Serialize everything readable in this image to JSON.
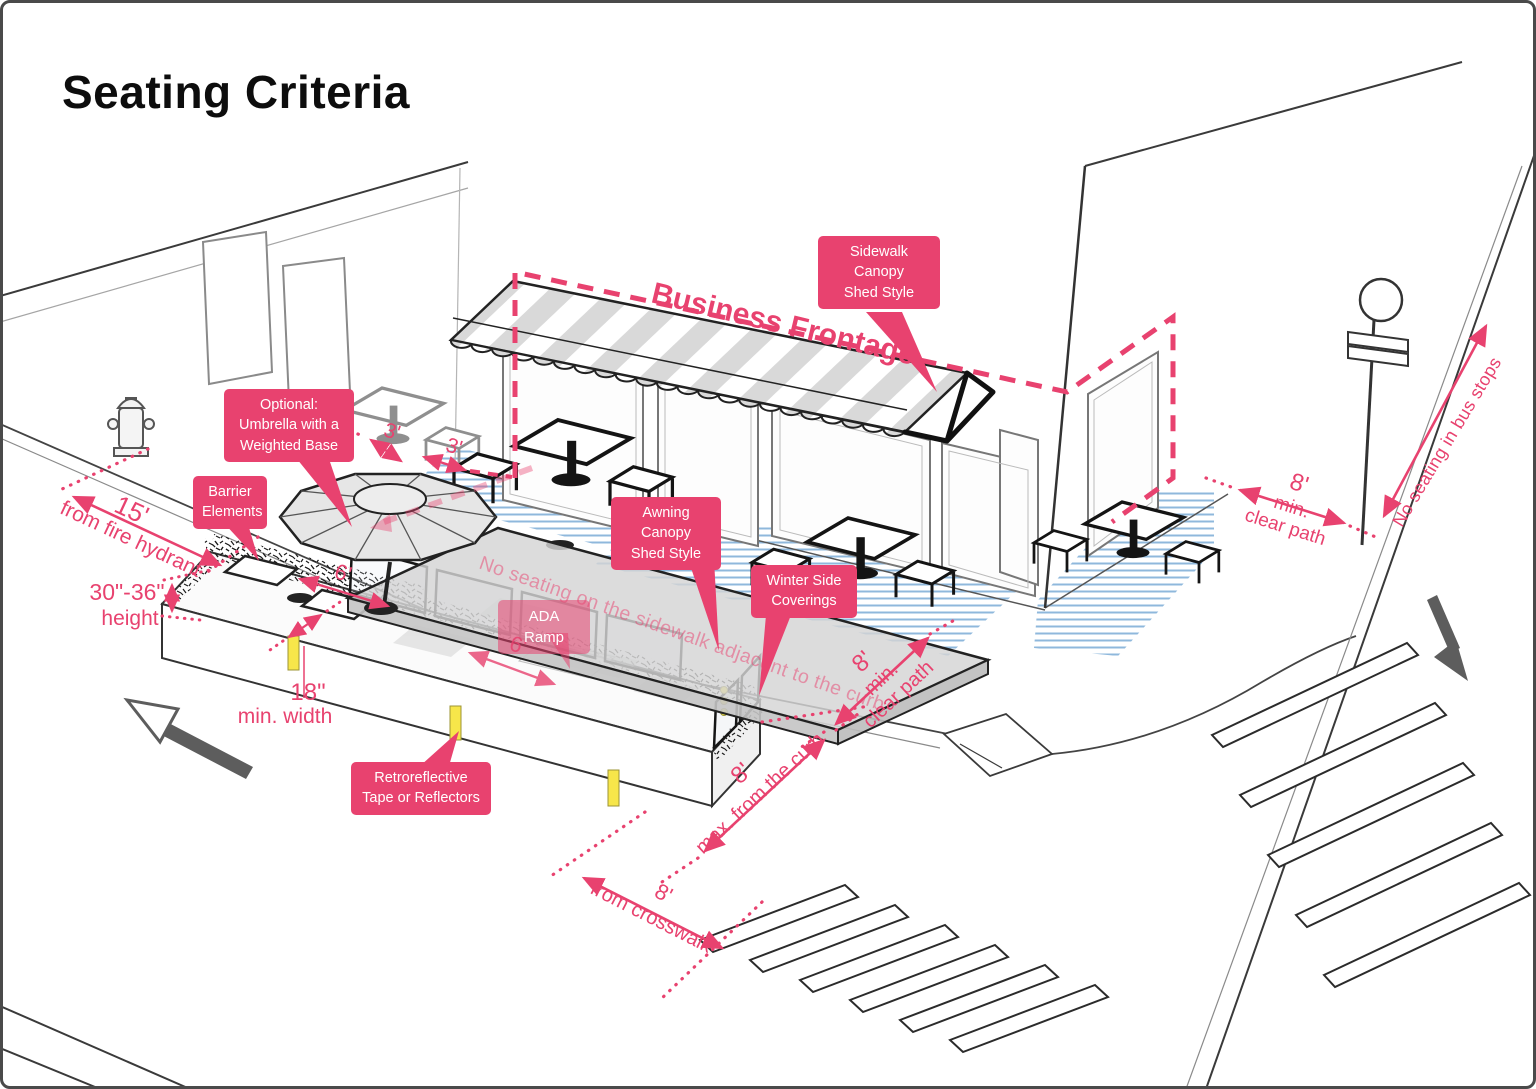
{
  "title": "Seating Criteria",
  "colors": {
    "accent": "#E8426F",
    "hatch_blue": "#8FB8DC",
    "tape_yellow": "#F7E64A",
    "line": "#3a3a3a"
  },
  "labels": {
    "sidewalk_canopy": {
      "lines": [
        "Sidewalk",
        "Canopy",
        "Shed Style"
      ]
    },
    "optional_umbrella": {
      "lines": [
        "Optional:",
        "Umbrella with a",
        "Weighted Base"
      ]
    },
    "barrier_elements": {
      "lines": [
        "Barrier",
        "Elements"
      ]
    },
    "awning_canopy": {
      "lines": [
        "Awning",
        "Canopy",
        "Shed Style"
      ]
    },
    "winter_side_coverings": {
      "lines": [
        "Winter Side",
        "Coverings"
      ]
    },
    "retroreflective": {
      "lines": [
        "Retroreflective",
        "Tape or Reflectors"
      ]
    },
    "ada_ramp": {
      "lines": [
        "ADA Ramp"
      ]
    }
  },
  "annotations": {
    "business_frontage": "Business Frontage",
    "no_seating_sidewalk": "No seating on the sidewalk adjacent to the curb",
    "no_seating_bus_stops": "No seating in bus stops"
  },
  "dimensions": {
    "fire_hydrant": {
      "value": "15'",
      "label": "from fire hydrant"
    },
    "barrier_height": {
      "value": "30\"-36\"",
      "label": "height"
    },
    "barrier_width": {
      "value": "18\"",
      "label": "min. width"
    },
    "frontage_setback_a": {
      "value": "3'"
    },
    "frontage_setback_b": {
      "value": "3'"
    },
    "umbrella_clearance": {
      "value": "6'"
    },
    "ada_ramp_width": {
      "value": "6'"
    },
    "clear_path_corner": {
      "value": "8'",
      "label_line1": "min.",
      "label_line2": "clear path"
    },
    "clear_path_bus": {
      "value": "8'",
      "label_line1": "min.",
      "label_line2": "clear path"
    },
    "curb_setback": {
      "value": "8'",
      "label": "max. from the curb"
    },
    "crosswalk_setback": {
      "value": "8'",
      "label": "from crosswalk"
    }
  }
}
